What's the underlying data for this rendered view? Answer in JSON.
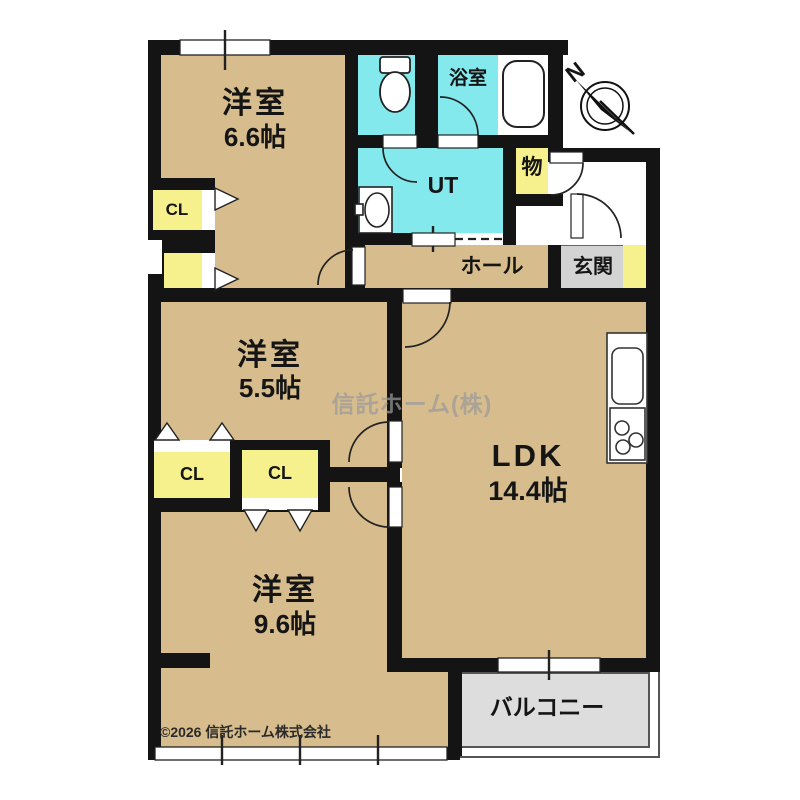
{
  "rooms": {
    "western1": {
      "name": "洋室",
      "size": "6.6帖"
    },
    "western2": {
      "name": "洋室",
      "size": "5.5帖"
    },
    "western3": {
      "name": "洋室",
      "size": "9.6帖"
    },
    "ldk": {
      "name": "LDK",
      "size": "14.4帖"
    },
    "bathroom": {
      "label": "浴室"
    },
    "utility": {
      "label": "UT"
    },
    "storage": {
      "label": "物"
    },
    "hall": {
      "label": "ホール"
    },
    "entrance": {
      "label": "玄関"
    },
    "balcony": {
      "label": "バルコニー"
    },
    "closet_66": {
      "label": "CL"
    },
    "closet_mid_left": {
      "label": "CL"
    },
    "closet_mid_right": {
      "label": "CL"
    }
  },
  "compass": {
    "label": "N"
  },
  "watermark": {
    "text": "信託ホーム(株)"
  },
  "footer": {
    "copyright": "©2026 信託ホーム株式会社"
  },
  "colors": {
    "room_tan": "#d7bc8d",
    "wet_cyan": "#84e9ec",
    "closet_yellow": "#f7f18d",
    "entrance_gray": "#d3d3d3",
    "balcony_gray": "#dddddd",
    "wall": "#141414"
  }
}
